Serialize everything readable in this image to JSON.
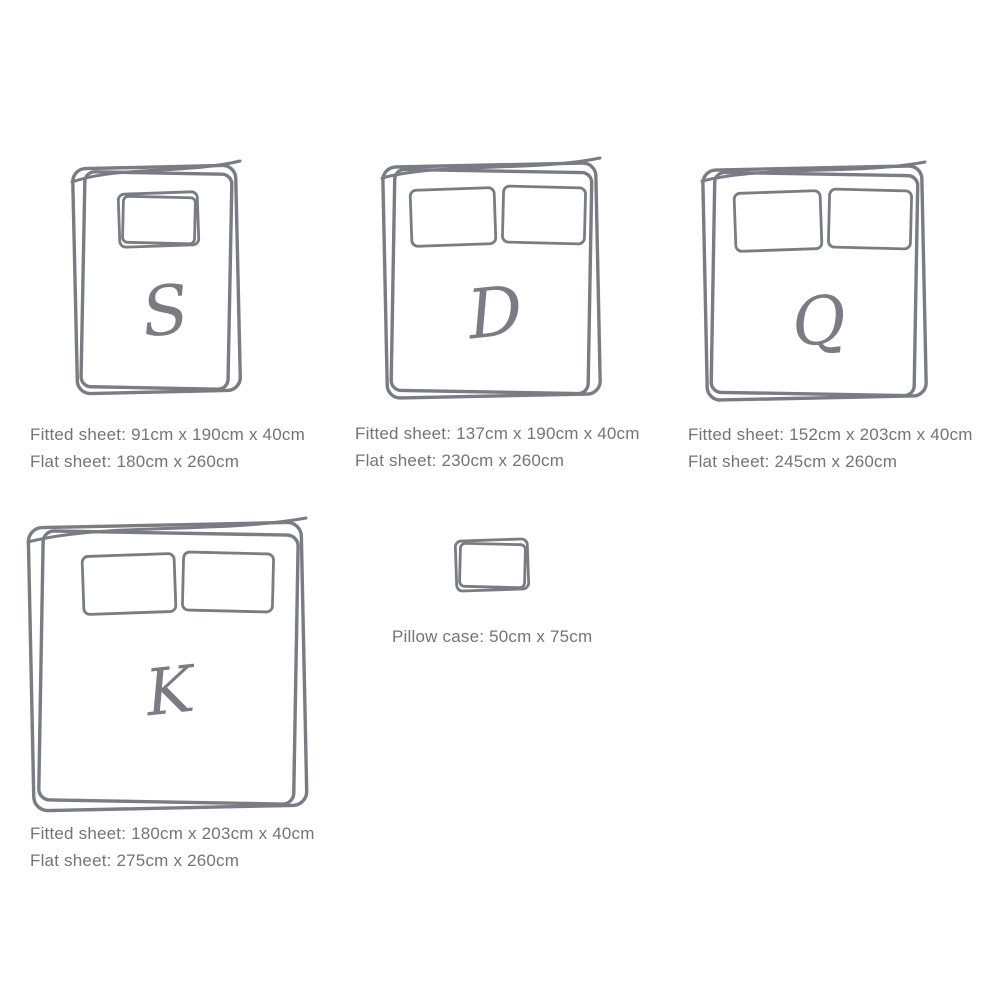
{
  "theme": {
    "background": "#ffffff",
    "line-color": "#7b7b84",
    "text-color": "#73737b"
  },
  "beds": [
    {
      "name": "single",
      "letter": "S",
      "pillow_count": 1,
      "fitted_line": "Fitted sheet: 91cm x 190cm x 40cm",
      "flat_line": "Flat sheet: 180cm x 260cm"
    },
    {
      "name": "double",
      "letter": "D",
      "pillow_count": 2,
      "fitted_line": "Fitted sheet: 137cm x 190cm x 40cm",
      "flat_line": "Flat sheet: 230cm x 260cm"
    },
    {
      "name": "queen",
      "letter": "Q",
      "pillow_count": 2,
      "fitted_line": "Fitted sheet: 152cm x 203cm x 40cm",
      "flat_line": "Flat sheet: 245cm x 260cm"
    },
    {
      "name": "king",
      "letter": "K",
      "pillow_count": 2,
      "fitted_line": "Fitted sheet: 180cm x 203cm x 40cm",
      "flat_line": "Flat sheet: 275cm x 260cm"
    }
  ],
  "pillow_case": {
    "label_line": "Pillow case: 50cm x 75cm"
  }
}
